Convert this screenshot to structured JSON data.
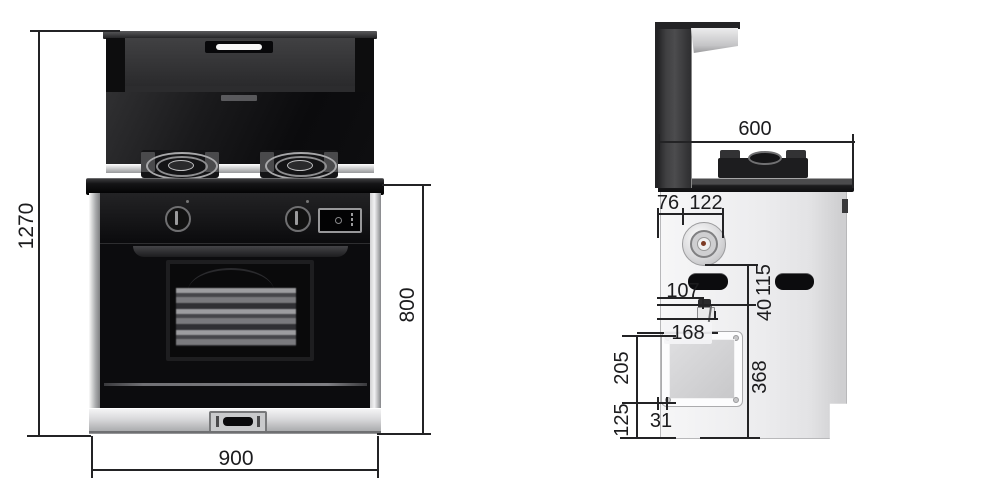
{
  "dimensions": {
    "front": {
      "overall_height": "1270",
      "body_height": "800",
      "width": "900"
    },
    "side": {
      "depth": "600",
      "hood_offset": "76",
      "knob_span": "122",
      "inlet_offset": "107",
      "panel_offset": "168",
      "panel_height": "205",
      "bottom_margin": "125",
      "panel_inset": "31",
      "lower_height": "368",
      "inlet_drop": "40",
      "slot_height": "115"
    }
  }
}
